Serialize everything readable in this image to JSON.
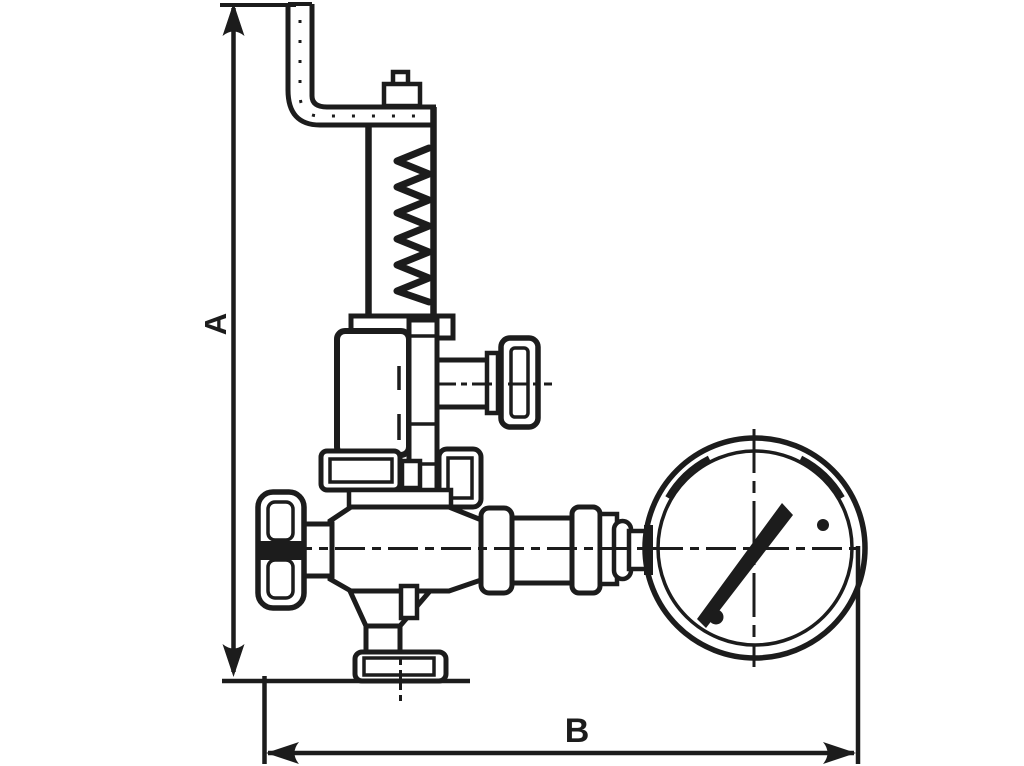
{
  "figure": {
    "type": "technical-line-drawing",
    "description": "Dimensional outline drawing of an angle safety relief valve with hand lever, spring bonnet, side handwheel and attached pressure gauge",
    "background_color": "#ffffff",
    "line_color": "#1c1c1c"
  },
  "dimension_labels": {
    "vertical": "A",
    "horizontal": "B"
  },
  "parts": {
    "lever": "lifting-lever",
    "cap": "spindle-cap",
    "spring_housing": "spring-housing-tube",
    "spring": "coil-spring",
    "bonnet": "bonnet",
    "side_outlet": "side-outlet-with-plug-cap",
    "union_nut": "union-nut",
    "body": "valve-body",
    "handwheel": "handwheel",
    "inlet": "threaded-inlet-with-flange",
    "piping": "gauge-connection-fittings",
    "gauge": "pressure-gauge"
  }
}
